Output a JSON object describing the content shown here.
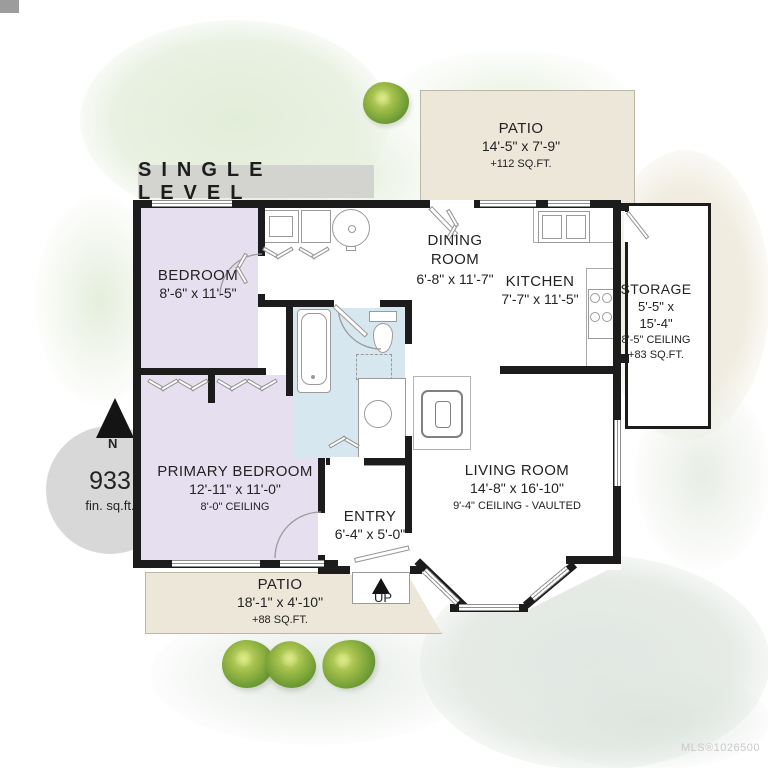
{
  "page": {
    "banner": "SINGLE LEVEL",
    "watermark": "MLS®1026500",
    "compass_label": "N",
    "area": {
      "value": "933",
      "unit": "fin. sq.ft."
    },
    "stairs": {
      "label": "UP"
    }
  },
  "rooms": {
    "patio_top": {
      "name": "PATIO",
      "dims": "14'-5\" x 7'-9\"",
      "note": "+112 SQ.FT."
    },
    "bedroom": {
      "name": "BEDROOM",
      "dims": "8'-6\" x 11'-5\""
    },
    "dining": {
      "name": "DINING\nROOM",
      "dims": "6'-8\" x 11'-7\""
    },
    "kitchen": {
      "name": "KITCHEN",
      "dims": "7'-7\" x 11'-5\""
    },
    "storage": {
      "name": "STORAGE",
      "dims": "5'-5\" x\n15'-4\"",
      "ceiling": "8'-5\" CEILING",
      "note": "+83 SQ.FT."
    },
    "primary_bedroom": {
      "name": "PRIMARY BEDROOM",
      "dims": "12'-11\" x 11'-0\"",
      "ceiling": "8'-0\" CEILING"
    },
    "living_room": {
      "name": "LIVING ROOM",
      "dims": "14'-8\" x 16'-10\"",
      "ceiling": "9'-4\" CEILING - VAULTED"
    },
    "entry": {
      "name": "ENTRY",
      "dims": "6'-4\" x 5'-0\""
    },
    "patio_bottom": {
      "name": "PATIO",
      "dims": "18'-1\" x 4'-10\"",
      "note": "+88 SQ.FT."
    }
  },
  "colors": {
    "wall": "#1c1c1c",
    "bedroom_fill": "#e6dff0",
    "bathroom_fill": "#d7e7f0",
    "patio_fill": "#ece7d8",
    "banner_bg": "#d3d3cf",
    "area_circle": "#d8d8d8",
    "bush_green": "#78a238"
  }
}
